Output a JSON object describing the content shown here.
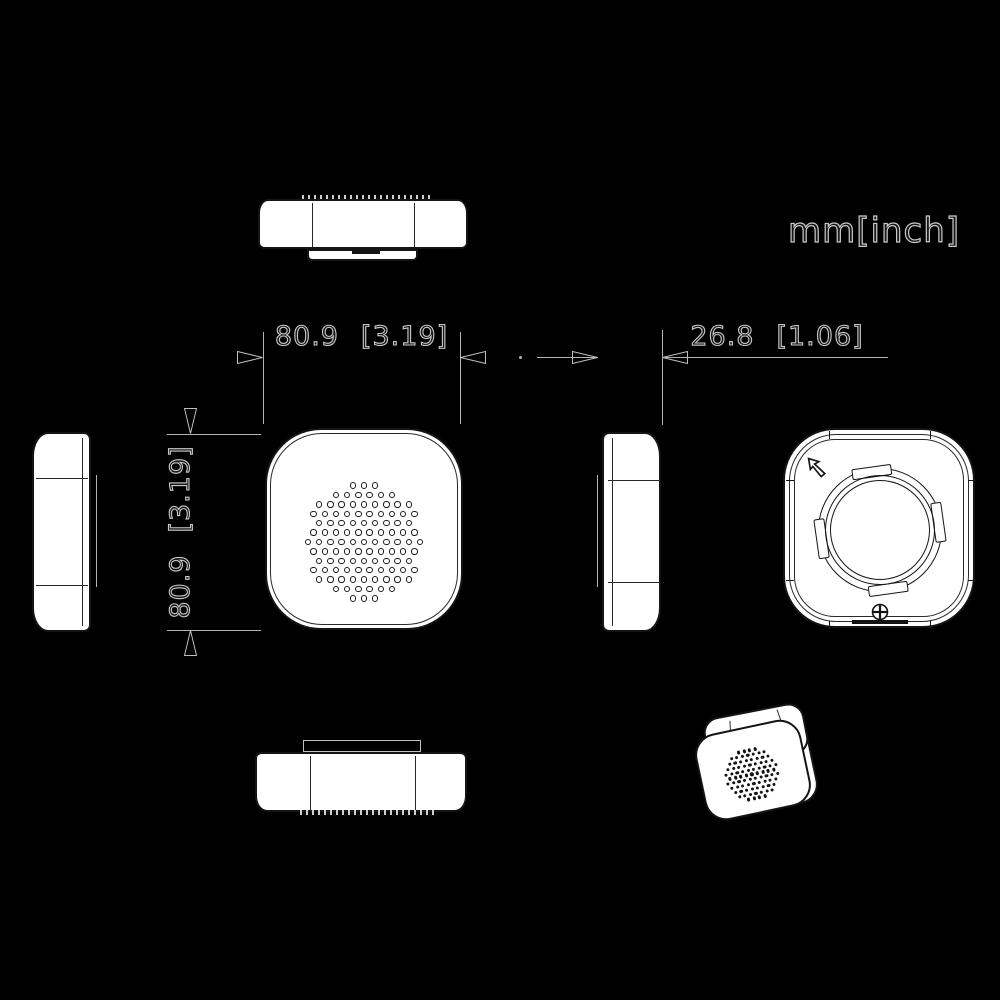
{
  "units_label": "mm[inch]",
  "dimensions": {
    "width": {
      "mm": "80.9",
      "inch": "[3.19]"
    },
    "height": {
      "mm": "80.9",
      "inch": "[3.19]"
    },
    "depth": {
      "mm": "26.8",
      "inch": "[1.06]"
    }
  },
  "colors": {
    "background": "#000000",
    "dimension_line": "#b4b4b4",
    "view_fill": "#ffffff",
    "view_stroke": "#141414"
  },
  "patterns": {
    "front_speaker": {
      "center_x": 97,
      "center_y": 112,
      "spacing": 11.2,
      "row_height": 9.4,
      "cluster_radius": 59,
      "hole_radius": 3.2,
      "style": "ring"
    },
    "iso_speaker": {
      "center_x": 50,
      "center_y": 46,
      "spacing": 5.6,
      "row_height": 4.8,
      "cluster_radius": 27,
      "hole_radius": 1.7,
      "style": "dot"
    }
  }
}
